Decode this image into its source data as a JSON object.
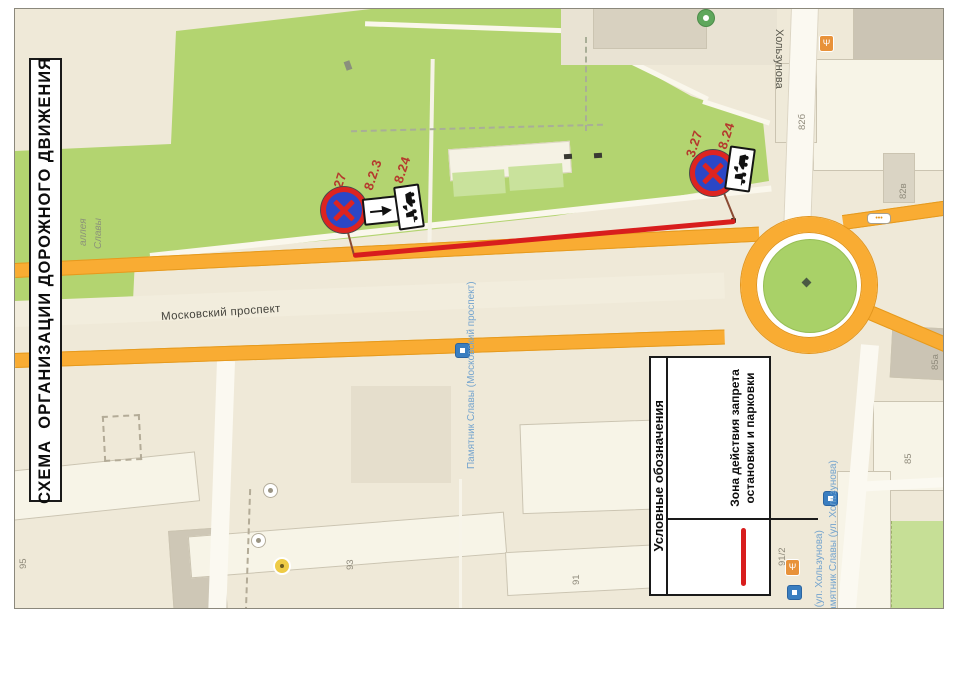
{
  "sheet_title": "СХЕМА  ОРГАНИЗАЦИИ ДОРОЖНОГО ДВИЖЕНИЯ",
  "legend": {
    "header": "Условные обозначения",
    "zone_label": "Зона действия запрета остановки и парковки"
  },
  "sign_groups": [
    {
      "labels": [
        "3.27",
        "8.2.3",
        "8.24"
      ]
    },
    {
      "labels": [
        "3.27",
        "8.24"
      ]
    }
  ],
  "map": {
    "streets": {
      "moskovsky": "Московский проспект",
      "kholzunova": "Хользунова",
      "alley_line1": "аллея",
      "alley_line2": "Славы"
    },
    "transit_stops": {
      "stop_moskovsky": "Памятник Славы (Московский проспект)",
      "stop_kholzunova_1": "Памятник Славы (ул. Хользунова)",
      "stop_kholzunova_2": "Памятник Славы (ул. Хользунова)"
    },
    "buildings": [
      "95",
      "93",
      "91",
      "91/2",
      "85",
      "85а",
      "82б",
      "82в"
    ],
    "road_badge": "•••"
  },
  "colors": {
    "park_green": "#b3d470",
    "road_orange": "#f9ac33",
    "zone_red": "#d81d1d",
    "sign_blue": "#2b47c6",
    "sign_red": "#dd2420",
    "map_background": "#efe9d8",
    "transit_blue": "#74a4ce"
  }
}
